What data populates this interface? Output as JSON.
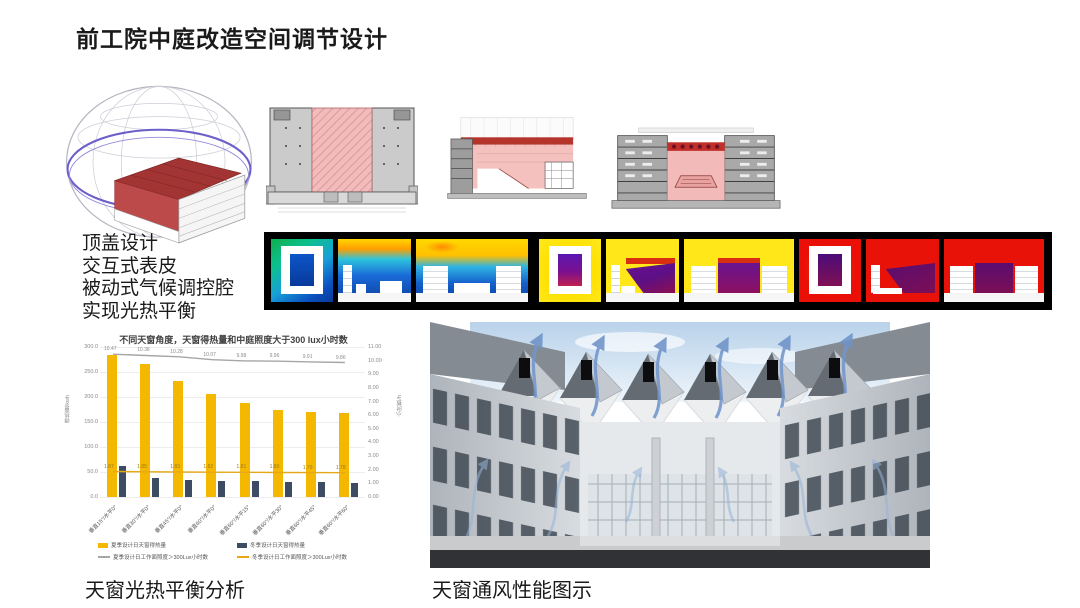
{
  "slide": {
    "title": "前工院中庭改造空间调节设计"
  },
  "notes": {
    "lines": [
      "顶盖设计",
      "交互式表皮",
      "被动式气候调控腔",
      "实现光热平衡"
    ]
  },
  "captions": {
    "chart": "天窗光热平衡分析",
    "render": "天窗通风性能图示"
  },
  "chart_data": {
    "type": "bar",
    "title": "不同天窗角度，天窗得热量和中庭照度大于300 lux小时数",
    "categories": [
      "垂直15°/水平0°",
      "垂直30°/水平0°",
      "垂直45°/水平0°",
      "垂直60°/水平0°",
      "垂直60°/水平15°",
      "垂直60°/水平30°",
      "垂直60°/水平45°",
      "垂直60°/水平60°"
    ],
    "series": [
      {
        "name": "夏季设计日天窗得热量",
        "type": "bar",
        "axis": "left",
        "color": "#F5B800",
        "values": [
          285,
          266,
          233,
          206,
          188,
          174,
          171,
          168
        ]
      },
      {
        "name": "冬季设计日天窗得热量",
        "type": "bar",
        "axis": "left",
        "color": "#3D4C63",
        "values": [
          62,
          38,
          35,
          33,
          32,
          31,
          30,
          29
        ]
      },
      {
        "name": "夏季设计日工作面照度＞300Lux小时数",
        "type": "line",
        "axis": "right",
        "color": "#A6A6A6",
        "values": [
          10.47,
          10.38,
          10.28,
          10.07,
          9.98,
          9.96,
          9.91,
          9.86
        ]
      },
      {
        "name": "冬季设计日工作面照度＞300Lux小时数",
        "type": "line",
        "axis": "right",
        "color": "#E6A817",
        "values": [
          1.87,
          1.85,
          1.83,
          1.82,
          1.81,
          1.8,
          1.79,
          1.78
        ]
      }
    ],
    "left_axis": {
      "label": "得热量/kwh",
      "range": [
        0,
        300
      ],
      "ticks": [
        "300.0",
        "250.0",
        "200.0",
        "150.0",
        "100.0",
        "50.0",
        "0.0"
      ]
    },
    "right_axis": {
      "label": "小时数/h",
      "range": [
        0,
        11
      ],
      "ticks": [
        "11.00",
        "10.00",
        "9.00",
        "8.00",
        "7.00",
        "6.00",
        "5.00",
        "4.00",
        "3.00",
        "2.00",
        "1.00",
        "0.00"
      ]
    },
    "legend_position": "bottom",
    "grid": true
  },
  "theme": {
    "atrium_pink": "#F3BABA",
    "skylight_red": "#C0392B",
    "dome_ring_purple": "#6C5FC9",
    "arrow_blue": "#7296CC"
  }
}
